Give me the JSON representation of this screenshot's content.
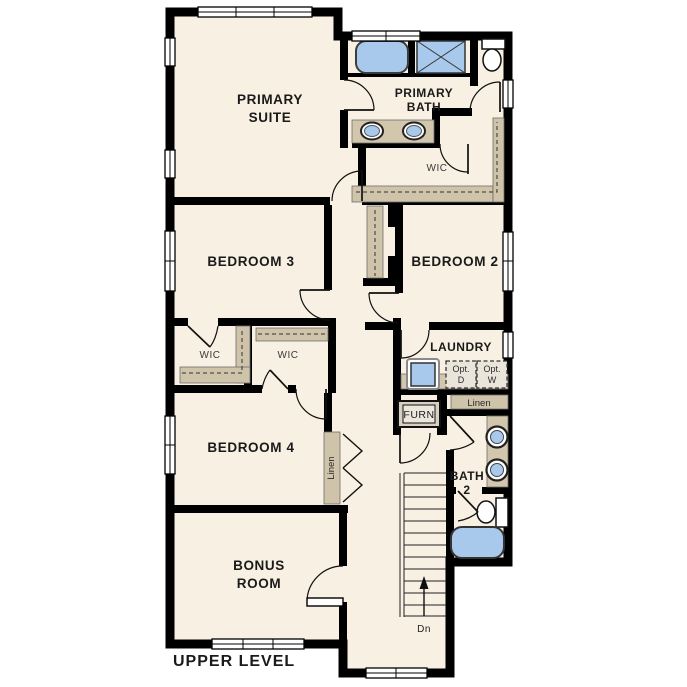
{
  "plan_title": "UPPER LEVEL",
  "rooms": {
    "primary_suite": {
      "line1": "PRIMARY",
      "line2": "SUITE"
    },
    "primary_bath": {
      "line1": "PRIMARY",
      "line2": "BATH"
    },
    "primary_wic": {
      "label": "WIC"
    },
    "bedroom3": {
      "label": "BEDROOM 3"
    },
    "bedroom2": {
      "label": "BEDROOM 2"
    },
    "wic_left": {
      "label": "WIC"
    },
    "wic_right": {
      "label": "WIC"
    },
    "laundry": {
      "label": "LAUNDRY"
    },
    "bedroom4": {
      "label": "BEDROOM 4"
    },
    "bath2": {
      "line1": "BATH",
      "line2": "2"
    },
    "bonus_room": {
      "line1": "BONUS",
      "line2": "ROOM"
    }
  },
  "closets": {
    "linen_hall": {
      "label": "Linen"
    },
    "linen_bedroom4": {
      "label": "Linen"
    }
  },
  "appliances": {
    "furnace": {
      "label": "FURN"
    },
    "opt_dryer": {
      "line1": "Opt.",
      "line2": "D"
    },
    "opt_washer": {
      "line1": "Opt.",
      "line2": "W"
    }
  },
  "stairs": {
    "down_label": "Dn"
  },
  "colors": {
    "background": "#ffffff",
    "floor": "#f8f0e2",
    "wall": "#000000",
    "shelf_tan": "#cfc3a9",
    "counter_tan": "#d2c6ac",
    "fixture_blue": "#a9c9ec",
    "dashed_box_fill": "#e9e5da"
  }
}
